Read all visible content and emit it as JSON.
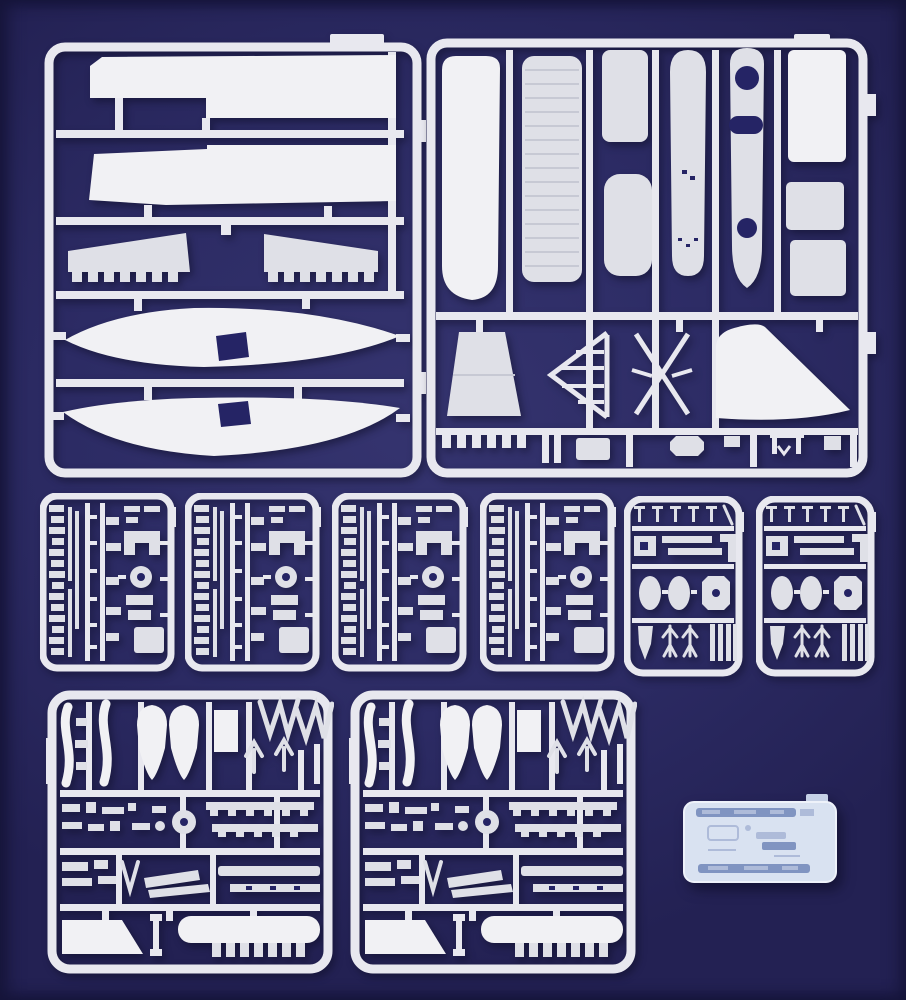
{
  "scene": {
    "type": "product-photograph",
    "subject": "Injection-molded plastic model aircraft kit sprues laid out on a dark blue background",
    "sprue_count": 10,
    "text_visible": "none"
  },
  "colors": {
    "bg": "#2c2b64",
    "bg_light": "#35346f",
    "bg_edge": "#16153a",
    "bg_edge2": "#232153",
    "hole": "#252465",
    "sprue": "#e8e8ef",
    "part": "#dfe0e7",
    "part_bright": "#f1f1f4",
    "part_dim": "#c7c9d4",
    "clear_base": "#d9e2f1",
    "clear_strip": "#8094c1",
    "clear_mid": "#aebbd9",
    "clear_tab": "#c6d1e6"
  },
  "sprues": [
    {
      "id": "A",
      "label": "Large airframe sprue A: two fuselage halves, two upper wing halves, two tailplanes with molding teeth"
    },
    {
      "id": "B",
      "label": "Large airframe sprue B: lower wing panels, flap panel, fuselage spine, cockpit floor with holes, bulkhead panels, tail fin, rudder, strut frames"
    },
    {
      "id": "C",
      "label": "Detail sprue (4 identical): rows of small fittings, thin spars, wheel, brackets"
    },
    {
      "id": "D",
      "label": "Small detail sprue (2 identical): pins, wheel spats, engine cowl front, darts and grille parts"
    },
    {
      "id": "E",
      "label": "Equipment sprue (2 identical): propeller blades, drop-tank halves, landing-gear V-struts, hatches and long panels"
    },
    {
      "id": "F",
      "label": "Clear sprue: transparent canopy glazing strips"
    }
  ]
}
